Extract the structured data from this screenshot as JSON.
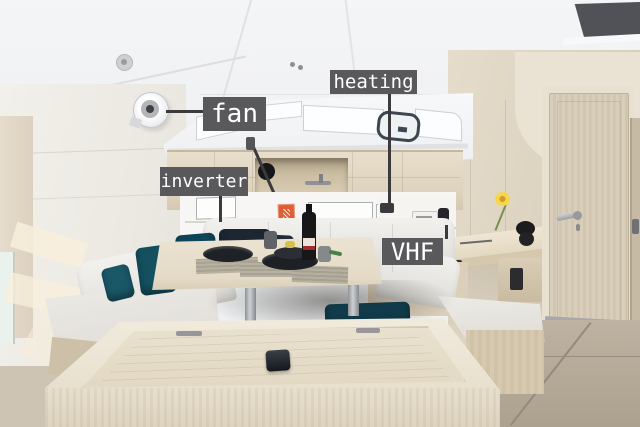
{
  "image": {
    "kind": "annotated photo",
    "scene": "sailboat salon interior with labeled equipment"
  },
  "annotations": {
    "fan": {
      "text": "fan"
    },
    "heating": {
      "text": "heating"
    },
    "inverter": {
      "text": "inverter"
    },
    "vhf": {
      "text": "VHF"
    }
  },
  "palette": {
    "label_bg": "#59595b",
    "label_text": "#ffffff",
    "leader_line": "#3b3b3d",
    "wood_light": "#ddd3c0",
    "sofa_white": "#eae9e6",
    "pillow_teal": "#14505f",
    "pillow_navy": "#1d2733",
    "floor_taupe": "#b3a897",
    "extinguisher_red": "#c03226",
    "flower_yellow": "#f5d84a"
  }
}
